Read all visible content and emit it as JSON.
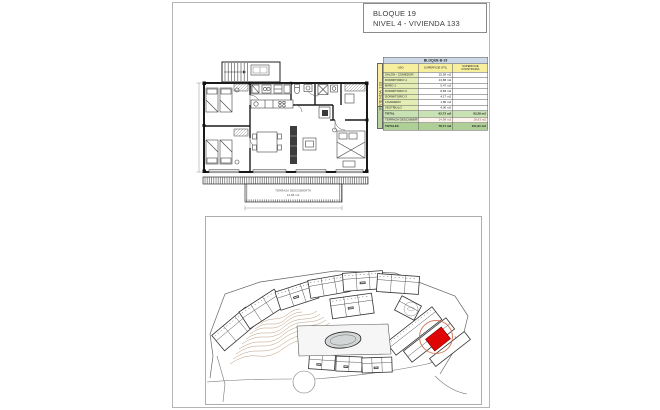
{
  "page": {
    "title_line1": "BLOQUE 19",
    "title_line2": "NIVEL 4 - VIVIENDA 133"
  },
  "table": {
    "block_header": "BLOQUE B-19",
    "side_label": "VIVIENDA 133",
    "col_uso": "USO",
    "col_util": "SUPERFICIE ÚTIL",
    "col_construida": "SUPERFICIE CONSTRUIDA",
    "rows": [
      {
        "uso": "SALÓN - COMEDOR",
        "util": "25,58 m2",
        "construida": ""
      },
      {
        "uso": "DORMITORIO 1",
        "util": "13,88 m2",
        "construida": ""
      },
      {
        "uso": "BAÑO 1",
        "util": "5,47 m2",
        "construida": ""
      },
      {
        "uso": "DORMITORIO 2",
        "util": "8,83 m2",
        "construida": ""
      },
      {
        "uso": "DORMITORIO 3",
        "util": "4,17 m2",
        "construida": ""
      },
      {
        "uso": "LAVADERO",
        "util": "1,80 m2",
        "construida": ""
      },
      {
        "uso": "VESTÍBULO",
        "util": "4,00 m2",
        "construida": ""
      }
    ],
    "total": {
      "uso": "TOTAL",
      "util": "63,73 m2",
      "construida": "83,28 m2"
    },
    "terraza": {
      "uso": "TERRAZA DESCUBIERTA",
      "util": "14,98 m2",
      "construida": "18,63 m2"
    },
    "totales": {
      "uso": "TOTALES",
      "util": "78,71 m2",
      "construida": "101,91 m2"
    }
  },
  "plan": {
    "terrace_label": "TERRAZA DESCUBIERTA",
    "terrace_area": "14,98 m2"
  },
  "colors": {
    "highlight_block": "#e00505",
    "selection_circle": "#cc6644",
    "contour_lines": "#b3906e",
    "header_blue": "#cdd9e6",
    "header_yellow": "#f7ef9e",
    "row_green": "#e3edb4",
    "total_green": "#aed096"
  }
}
